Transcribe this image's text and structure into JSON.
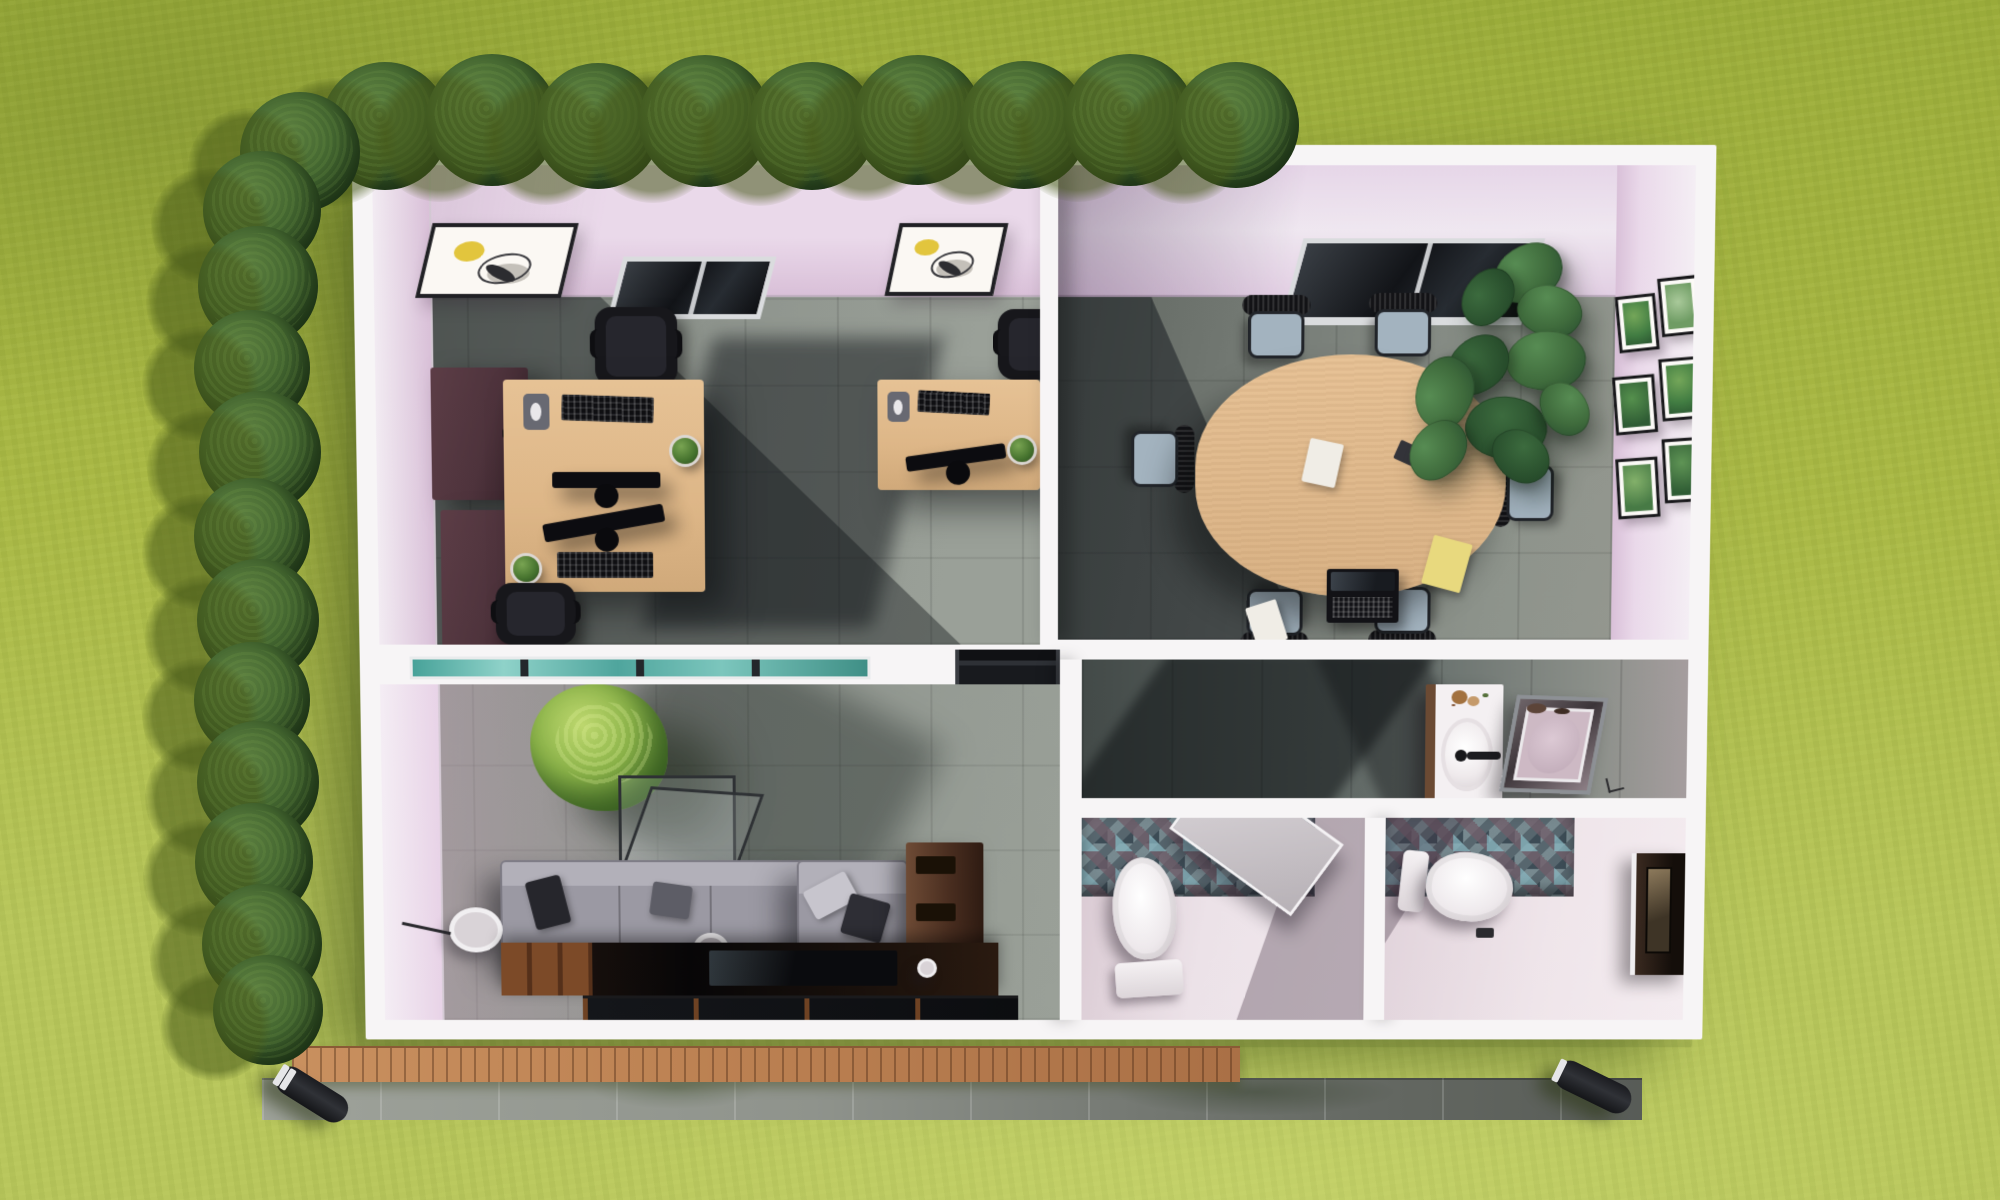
{
  "scene": {
    "type": "3d-aerial-floor-plan-render",
    "subject": "Small rectangular office building, roof removed, viewed from above on a lawn",
    "environment": {
      "lawn": "yellow-green grass",
      "hedge_rows": [
        "top edge",
        "left edge"
      ],
      "hedge_bush_count": 21,
      "garden_bollard_lights": 2,
      "wood_deck": "front of lounge",
      "paver_path": "along bottom facade"
    }
  },
  "palette": {
    "grass": "#a9b845",
    "grass_light": "#b8c65c",
    "grass_dark": "#9aab3a",
    "hedge": "#456831",
    "hedge_hi": "#5d8040",
    "hedge_lo": "#2d4a24",
    "hedge_shadow": "rgba(70,88,24,0.55)",
    "wall": "#f7f5f6",
    "wall_face": "#ead9ea",
    "wall_face_deep": "#d9c0d8",
    "floor": "#8d938c",
    "floor_dark": "#6f766f",
    "desk_wood": "#ddb687",
    "cabinet": "#4e333c",
    "black": "#17171b",
    "seat": "#a3b3bf",
    "sofa": "#9b99a3",
    "pillow": "#26262c",
    "glass_teal": "#59b1a8",
    "mosaic_blue": "#88b4be",
    "mosaic_mauve": "#6b5a64",
    "deck_wood": "#c08a58",
    "paver": "#8f938c",
    "porcelain": "#f3eff1",
    "mirror": "#cdb9c4",
    "paper": "#f0ede6",
    "note": "#e8d97e",
    "art_accent": "#e2c53d",
    "plant": "#3f6b3c",
    "plant_dark": "#2c5231",
    "tree": "#8db54a"
  },
  "rooms": [
    {
      "id": "office",
      "position": "top-left",
      "furniture": [
        "double-workstation-desk",
        "single-desk",
        "3 black office chairs",
        "2 dark storage cabinets",
        "3 keyboards",
        "3 monitors",
        "mouse pads",
        "4 desk plants",
        "2 abstract wall art frames",
        "window"
      ]
    },
    {
      "id": "meeting-room",
      "position": "top-right",
      "furniture": [
        "oval wood conference table",
        "6 chairs with grey seats",
        "laptop",
        "2 white papers",
        "yellow paper",
        "dark notebook",
        "monstera plant",
        "6 botanical gallery frames",
        "window"
      ]
    },
    {
      "id": "lounge",
      "position": "bottom-left",
      "furniture": [
        "grey sofa with chaise",
        "4 cushions",
        "glass cube coffee table",
        "indoor tree",
        "round side table",
        "floor lamp",
        "dark media wall with TV",
        "wood console",
        "teal clerestory window",
        "terrace glazing"
      ]
    },
    {
      "id": "washroom",
      "position": "bottom-right",
      "furniture": [
        "vanity with oval sink and black faucet",
        "chrome framed shower",
        "2 white toilets",
        "mosaic tiled walls",
        "light open stall door",
        "dark entry door"
      ]
    }
  ]
}
